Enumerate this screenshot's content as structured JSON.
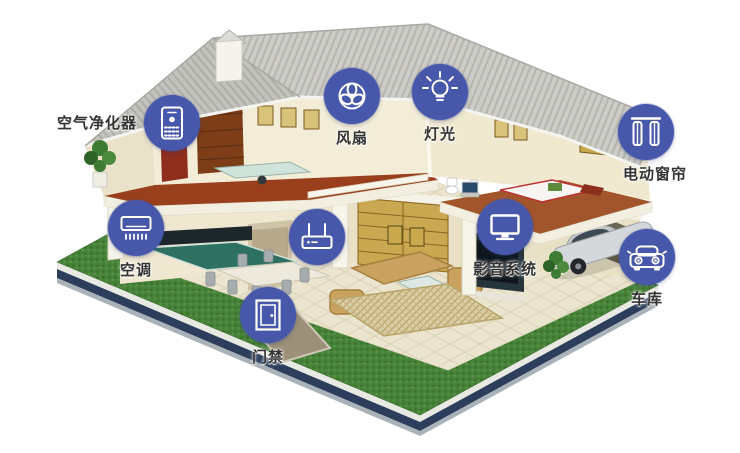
{
  "scene": {
    "type": "smart-home cutaway illustration"
  },
  "colors": {
    "badge_blue": "#4757a9",
    "icon_white": "#ffffff",
    "label_text": "#333333",
    "roof_gray": "#cdccc7",
    "wall_cream": "#f3edd8",
    "wood_floor": "#993f1c",
    "lawn_green": "#47823a",
    "base_navy": "#2c3e5c",
    "kitchen_teal": "#2e7163",
    "sofa_tan": "#c8a25e"
  },
  "devices": [
    {
      "id": "air-purifier",
      "label": "空气净化器",
      "icon": "air-purifier-icon"
    },
    {
      "id": "fan",
      "label": "风扇",
      "icon": "fan-icon"
    },
    {
      "id": "light",
      "label": "灯光",
      "icon": "lightbulb-icon"
    },
    {
      "id": "curtain",
      "label": "电动窗帘",
      "icon": "curtain-icon"
    },
    {
      "id": "ac",
      "label": "空调",
      "icon": "air-conditioner-icon"
    },
    {
      "id": "router",
      "label": "",
      "icon": "router-icon"
    },
    {
      "id": "av-system",
      "label": "影音系统",
      "icon": "tv-icon"
    },
    {
      "id": "door-access",
      "label": "门禁",
      "icon": "door-icon"
    },
    {
      "id": "garage",
      "label": "车库",
      "icon": "car-icon"
    }
  ]
}
